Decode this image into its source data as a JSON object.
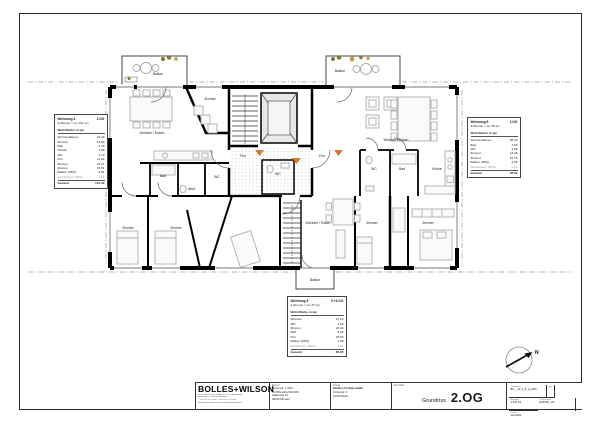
{
  "plan": {
    "labels": [
      {
        "t": "Balkon",
        "x": 158,
        "y": 75
      },
      {
        "t": "Balkon",
        "x": 340,
        "y": 72
      },
      {
        "t": "Balkon",
        "x": 315,
        "y": 281
      },
      {
        "t": "Wohnen / Essen",
        "x": 152,
        "y": 134
      },
      {
        "t": "Zimmer",
        "x": 210,
        "y": 100
      },
      {
        "t": "Bad",
        "x": 163,
        "y": 177
      },
      {
        "t": "Abst.",
        "x": 192,
        "y": 190
      },
      {
        "t": "WC",
        "x": 217,
        "y": 178
      },
      {
        "t": "Zimmer",
        "x": 128,
        "y": 229
      },
      {
        "t": "Zimmer",
        "x": 176,
        "y": 229
      },
      {
        "t": "Flur",
        "x": 243,
        "y": 157
      },
      {
        "t": "Flur",
        "x": 322,
        "y": 157
      },
      {
        "t": "WC",
        "x": 278,
        "y": 175
      },
      {
        "t": "Wohnen / Essen",
        "x": 318,
        "y": 224
      },
      {
        "t": "Zimmer",
        "x": 372,
        "y": 224
      },
      {
        "t": "Zimmer",
        "x": 428,
        "y": 224
      },
      {
        "t": "Wohnen / Essen",
        "x": 396,
        "y": 141
      },
      {
        "t": "WC",
        "x": 374,
        "y": 170
      },
      {
        "t": "Bad",
        "x": 402,
        "y": 170
      },
      {
        "t": "Küche",
        "x": 437,
        "y": 170
      }
    ],
    "colors": {
      "wall": "#000000",
      "door_marker": "#d97a2a",
      "plant_olive": "#7a7a33",
      "plant_gold": "#bf9e39",
      "hatch_dot": "#b5b5b5"
    }
  },
  "units": [
    {
      "name": "Wohnung 4",
      "floor": "2.OG",
      "subtitle": "3-Zimmer ≈ ca. 101 qm",
      "area_header": "Wohnfläche in qm",
      "rows": [
        [
          "Wohnen/Essen",
          "31.49"
        ],
        [
          "Zimmer",
          "13.09"
        ],
        [
          "Bad",
          "4.78"
        ],
        [
          "Abstell",
          "1.89"
        ],
        [
          "WC",
          "3.70"
        ],
        [
          "Flur",
          "11.62"
        ],
        [
          "Zimmer",
          "15.27"
        ],
        [
          "Zimmer",
          "15.51"
        ],
        [
          "Balkon (25%)",
          "2.81"
        ],
        [
          "Abstellraum (50%)",
          "1.24"
        ]
      ],
      "muted_rows": [
        9
      ],
      "total": [
        "Gesamt",
        "101.40"
      ]
    },
    {
      "name": "Wohnung 5",
      "floor": "2.+3.OG",
      "subtitle": "2-Zimmer ≈ ca. 87 qm",
      "area_header": "Wohnfläche in qm",
      "rows": [
        [
          "Wohnen",
          "27.14"
        ],
        [
          "WC",
          "1.66"
        ],
        [
          "Zimmer",
          "23.44"
        ],
        [
          "Bad",
          "5.62"
        ],
        [
          "Flur",
          "25.80"
        ],
        [
          "Balkon (25%)",
          "1.95"
        ],
        [
          "Abstellraum (50%)",
          "1.24"
        ]
      ],
      "muted_rows": [
        6
      ],
      "total": [
        "Gesamt",
        "86.85"
      ]
    },
    {
      "name": "Wohnung 6",
      "floor": "2.OG",
      "subtitle": "3-Zimmer ≈ ca. 95 qm",
      "area_header": "Wohnfläche in qm",
      "rows": [
        [
          "Wohnen/Essen",
          "56.43"
        ],
        [
          "Bad",
          "4.50"
        ],
        [
          "WC",
          "1.56"
        ],
        [
          "Zimmer",
          "13.28"
        ],
        [
          "Zimmer",
          "16.76"
        ],
        [
          "Balkon (25%)",
          "2.05"
        ],
        [
          "Abstellraum (50%)",
          "1.24"
        ]
      ],
      "muted_rows": [
        6
      ],
      "total": [
        "Gesamt",
        "95.82"
      ]
    }
  ],
  "titleblock": {
    "logo": "BOLLES+WILSON",
    "address_lines": [
      "BOLLES+WILSON GmbH & Co. KG  Architekten",
      "Hafenweg 16   D-48155 Münster",
      "T +49 251 59 70 80   F +49 251 59 70 888",
      "info@bolles-wilson.com   www.bolles-wilson.com"
    ],
    "client": {
      "header": "Bauherr",
      "lines": [
        "Frobenstr. 1 GbR",
        "c/o BOLLES+WILSON",
        "Hafenweg 16",
        "48155 Münster"
      ]
    },
    "project": {
      "header": "Projekt",
      "name": "Studios Frobenstraße",
      "lines": [
        "Frobenstr. 1",
        "10783 Berlin"
      ]
    },
    "content": {
      "header": "Planinhalt",
      "label": "Grundriss",
      "value": "2.OG"
    },
    "meta": {
      "file": {
        "header": "Dateiname",
        "value": "BF_-_W_0_5_A_ARC"
      },
      "drawn": {
        "header": "gez.",
        "value": ""
      },
      "scale": {
        "header": "Maßstab",
        "value": "1:100  A3"
      },
      "number": {
        "header": "Plannummer",
        "value": "E02/021_A3"
      },
      "date": {
        "header": "Datum",
        "value": "Juli 2020"
      }
    }
  },
  "north": {
    "label": "N"
  }
}
